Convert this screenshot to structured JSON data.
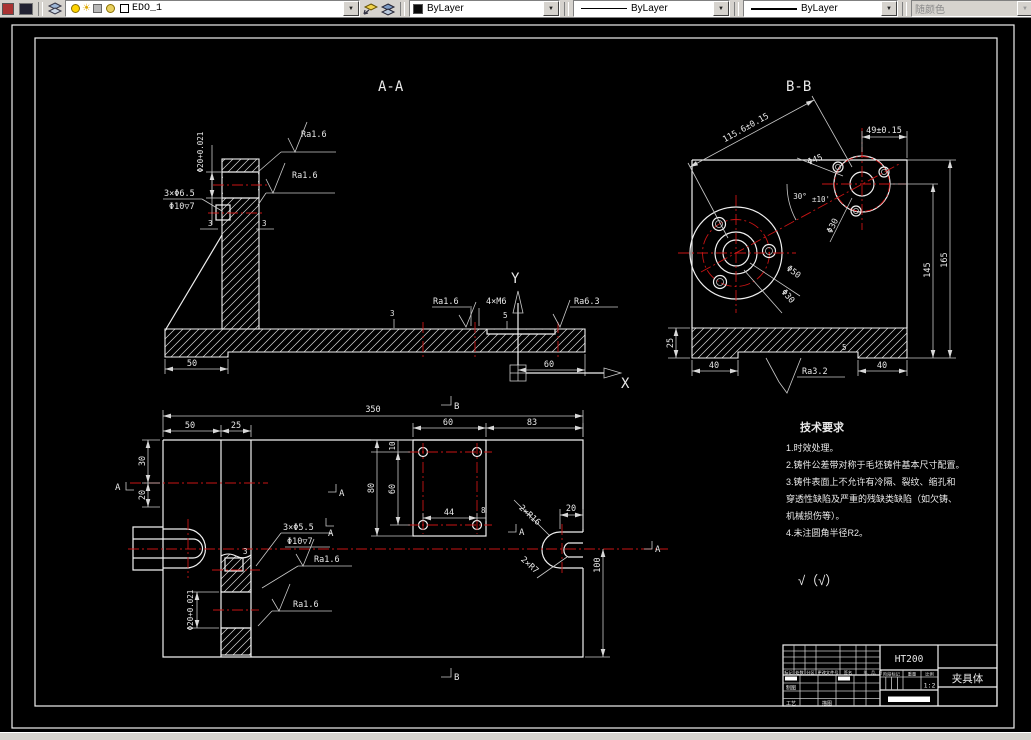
{
  "toolbar": {
    "layer_name": "EDO_1",
    "color_value": "ByLayer",
    "linetype_value": "ByLayer",
    "lineweight_value": "ByLayer",
    "plot_style_value": "随颜色"
  },
  "views": {
    "aa": {
      "title": "A-A",
      "ra_top": "Ra1.6",
      "ra_mid": "Ra1.6",
      "bore_dim": "Φ20+0.021",
      "holes_label": "3×Φ6.5",
      "cbore_label": "Φ10▽7",
      "dim_3a": "3",
      "dim_3b": "3",
      "dim_3c": "3",
      "dim_5": "5",
      "dim_50": "50",
      "dim_60": "60",
      "ra_base": "Ra1.6",
      "thread_label": "4×M6",
      "ra_right": "Ra6.3",
      "axis_x": "X",
      "axis_y": "Y"
    },
    "bb": {
      "title": "B-B",
      "dim_centers": "115.6±0.15",
      "dim_49": "49±0.15",
      "dia_45": "Φ45",
      "angle_30": "30°",
      "angle_tol": "±10'",
      "dia_50": "Φ50",
      "dia_30a": "Φ30",
      "dia_30b": "Φ30",
      "dim_145": "145",
      "dim_165": "165",
      "dim_25": "25",
      "dim_40l": "40",
      "dim_40r": "40",
      "dim_5": "5",
      "ra_bottom": "Ra3.2"
    },
    "plan": {
      "dim_350": "350",
      "dim_50": "50",
      "dim_25": "25",
      "dim_30": "30",
      "dim_20": "20",
      "dim_60_top": "60",
      "dim_83": "83",
      "dim_10": "10",
      "dim_60_left": "60",
      "dim_80": "80",
      "dim_44": "44",
      "dim_8": "8",
      "dim_20_slot": "20",
      "dim_100": "100",
      "r16_label": "2×R16",
      "r7_label": "2×R7",
      "holes_label": "3×Φ5.5",
      "cbore_label": "Φ10▽7",
      "ra_1": "Ra1.6",
      "ra_2": "Ra1.6",
      "bore_dim": "Φ20+0.021",
      "dim_3": "3",
      "flag_a": "A",
      "flag_b": "B"
    },
    "tech_req": {
      "title": "技术要求",
      "lines": [
        "1.时效处理。",
        "2.铸件公差带对称于毛坯铸件基本尺寸配置。",
        "3.铸件表面上不允许有冷隔、裂纹、缩孔和",
        "穿透性缺陷及严重的残缺类缺陷（如欠铸、",
        "机械损伤等）。",
        "4.未注圆角半径R2。"
      ]
    },
    "finish_note": "√（√）",
    "title_block": {
      "material": "HT200",
      "part_name": "夹具体",
      "stage_label": "阶段标记",
      "weight_label": "重量",
      "scale_label": "比例",
      "scale_value": "1:2",
      "rev_headers": [
        "标记",
        "处数",
        "分区",
        "更改文件号",
        "签名",
        "年、月、日"
      ],
      "sig_draw": "制图",
      "sig_process": "工艺",
      "sig_trace": "描图"
    }
  }
}
